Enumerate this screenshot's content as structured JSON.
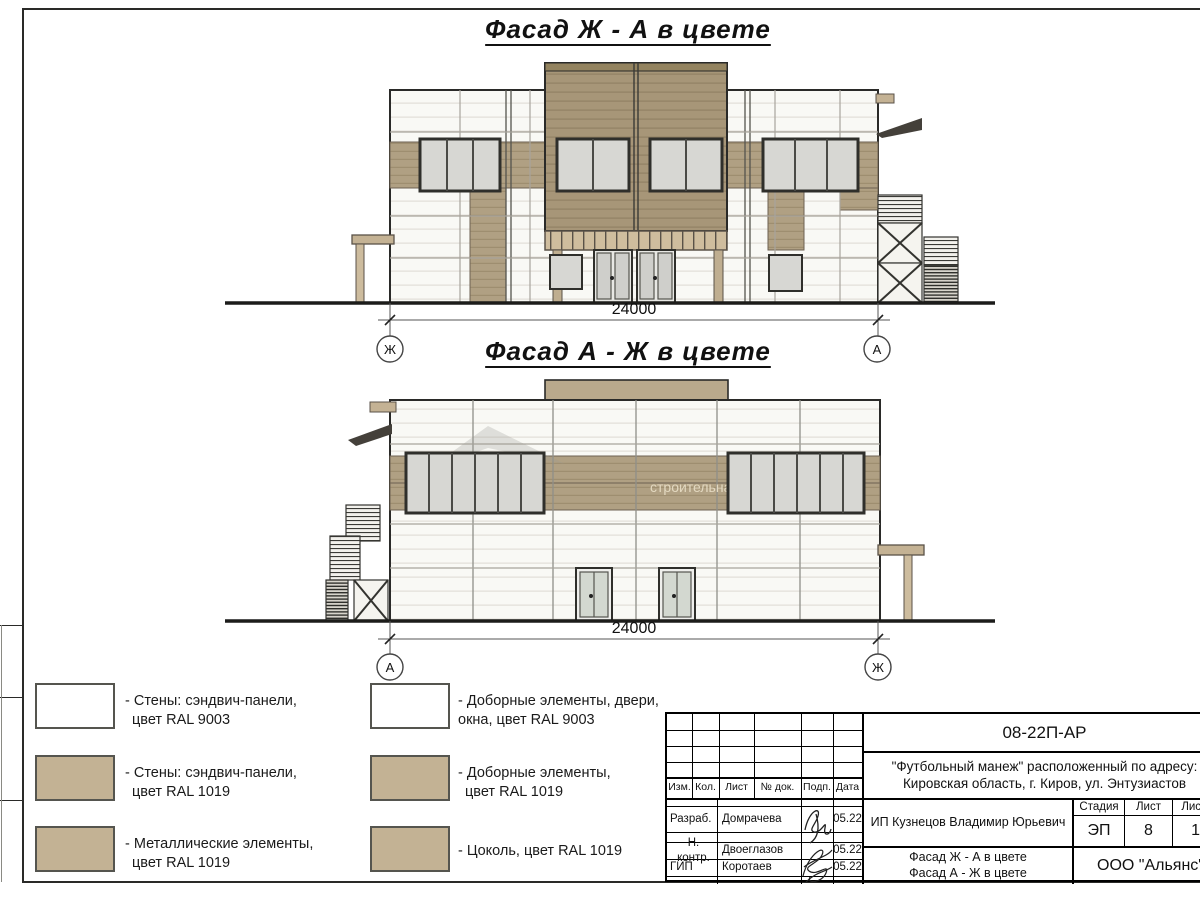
{
  "sheet": {
    "facade1": {
      "title": "Фасад Ж - А в цвете",
      "dimension": "24000",
      "axis_left": "Ж",
      "axis_right": "А"
    },
    "facade2": {
      "title": "Фасад А - Ж в цвете",
      "dimension": "24000",
      "axis_left": "А",
      "axis_right": "Ж"
    },
    "watermark": "строительная компания"
  },
  "legend": {
    "left": [
      {
        "ral": "RAL 9003",
        "color": "#ffffff",
        "lines": [
          "- Стены: сэндвич-панели,",
          "цвет RAL 9003"
        ]
      },
      {
        "ral": "RAL 1019",
        "color": "#c3b294",
        "lines": [
          "- Стены: сэндвич-панели,",
          "цвет RAL 1019"
        ]
      },
      {
        "ral": "RAL 1019",
        "color": "#c3b294",
        "lines": [
          "- Металлические элементы,",
          "цвет RAL 1019"
        ]
      }
    ],
    "right": [
      {
        "ral": "RAL 9003",
        "color": "#ffffff",
        "lines": [
          "- Доборные элементы, двери,",
          "окна, цвет RAL 9003"
        ]
      },
      {
        "ral": "RAL 1019",
        "color": "#c3b294",
        "lines": [
          "- Доборные элементы,",
          "цвет RAL 1019"
        ]
      },
      {
        "ral": "RAL 1019",
        "color": "#c3b294",
        "lines": [
          "- Цоколь, цвет RAL 1019"
        ]
      }
    ]
  },
  "titleblock": {
    "doc_number": "08-22П-АР",
    "project_line1": "\"Футбольный манеж\" расположенный по адресу:",
    "project_line2": "Кировская область, г. Киров, ул. Энтузиастов",
    "client": "ИП Кузнецов Владимир Юрьевич",
    "columns": [
      "Изм.",
      "Кол.",
      "Лист",
      "№ док.",
      "Подп.",
      "Дата"
    ],
    "rows": [
      {
        "role": "Разраб.",
        "name": "Домрачева",
        "date": "05.22"
      },
      {
        "role": "Н. контр.",
        "name": "Двоеглазов",
        "date": "05.22"
      },
      {
        "role": "ГИП",
        "name": "Коротаев",
        "date": "05.22"
      }
    ],
    "stage_label": "Стадия",
    "sheet_label": "Лист",
    "sheets_label": "Листов",
    "stage": "ЭП",
    "sheet_number": "8",
    "sheets_total": "17",
    "title_line1": "Фасад Ж - А в цвете",
    "title_line2": "Фасад А - Ж в цвете",
    "company": "ООО \"Альянс\""
  },
  "colors": {
    "wall_white": "#f8f8f5",
    "facade_tan": "#b0a083",
    "legend_tan": "#c3b294"
  }
}
